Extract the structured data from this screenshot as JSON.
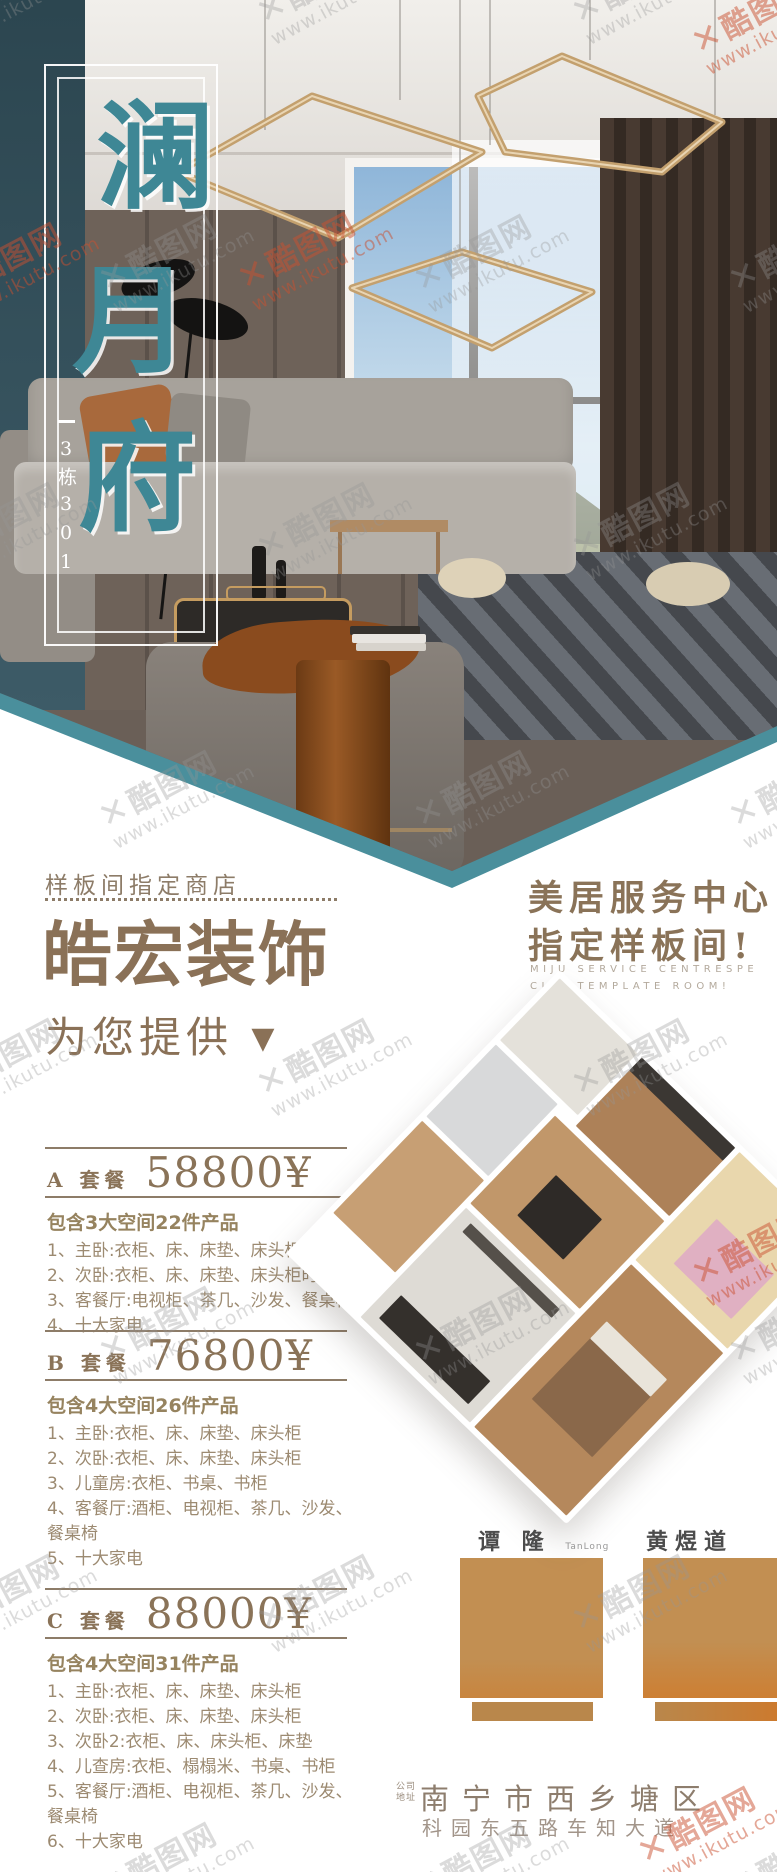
{
  "hero": {
    "title_chars": [
      "澜",
      "月",
      "府"
    ],
    "building_label": "3栋301"
  },
  "intro": {
    "tagline": "样板间指定商店",
    "brand": "皓宏装饰",
    "provide": "为您提供",
    "arrow": "▼",
    "right_line1": "美居服务中心",
    "right_line2": "指定样板间!",
    "right_en1": "MIJU SERVICE CENTRESPE",
    "right_en2": "CIFY TEMPLATE ROOM!"
  },
  "packages": [
    {
      "tier": "A 套餐",
      "price": "58800¥",
      "summary": "包含3大空间22件产品",
      "items": [
        "1、主卧:衣柜、床、床垫、床头柜",
        "2、次卧:衣柜、床、床垫、床头柜时",
        "3、客餐厅:电视柜、茶几、沙发、餐桌椅",
        "4、十大家电"
      ]
    },
    {
      "tier": "B 套餐",
      "price": "76800¥",
      "summary": "包含4大空间26件产品",
      "items": [
        "1、主卧:衣柜、床、床垫、床头柜",
        "2、次卧:衣柜、床、床垫、床头柜",
        "3、儿童房:衣柜、书桌、书柜",
        "4、客餐厅:酒柜、电视柜、茶几、沙发、餐桌椅",
        "5、十大家电"
      ]
    },
    {
      "tier": "C 套餐",
      "price": "88000¥",
      "summary": "包含4大空间31件产品",
      "items": [
        "1、主卧:衣柜、床、床垫、床头柜",
        "2、次卧:衣柜、床、床垫、床头柜",
        "3、次卧2:衣柜、床、床头柜、床垫",
        "4、儿查房:衣柜、榻榻米、书桌、书柜",
        "5、客餐厅:酒柜、电视柜、茶几、沙发、餐桌椅",
        "6、十大家电"
      ]
    }
  ],
  "designers": [
    {
      "name": "谭 隆",
      "latin": "TanLong"
    },
    {
      "name": "黄煜道",
      "latin": ""
    }
  ],
  "footer": {
    "label_line1": "公司",
    "label_line2": "地址",
    "address_line1": "南宁市西乡塘区",
    "address_line2": "科园东五路车知大道"
  },
  "watermark": {
    "logo": "✕",
    "brand": "酷图网",
    "url": "www.ikutu.com"
  },
  "colors": {
    "teal_accent": "#4a8f9c",
    "title_teal": "#3e8795",
    "brown_heading": "#8a7157",
    "list_brown": "#9c8a71",
    "portrait_tan": "#c28f52"
  }
}
